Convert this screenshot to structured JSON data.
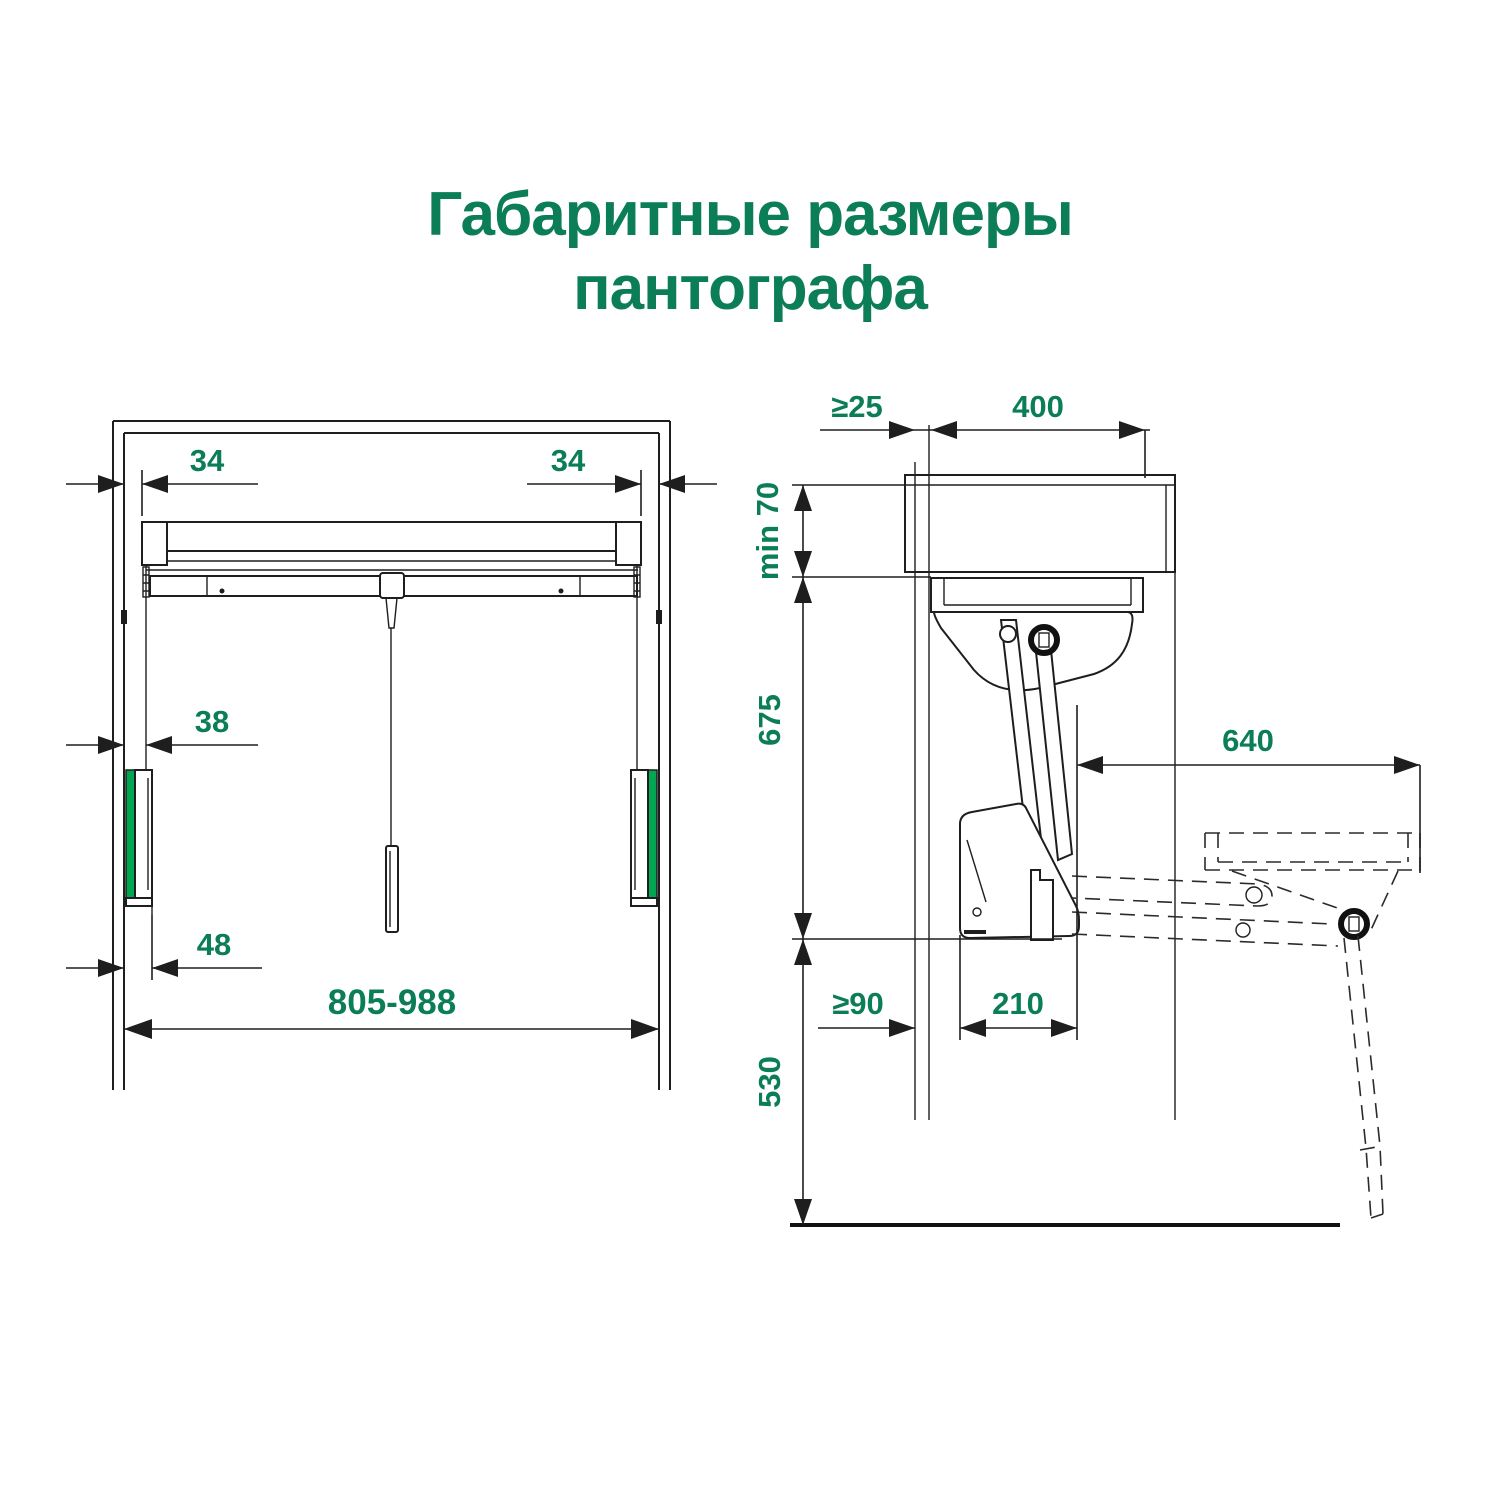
{
  "title": {
    "line1": "Габаритные размеры",
    "line2": "пантографа"
  },
  "colors": {
    "accent_green": "#0B7D57",
    "bright_green": "#00A651",
    "line": "#1E1E1E"
  },
  "front_view": {
    "dims": {
      "offset_left": "34",
      "offset_right": "34",
      "cable_offset": "38",
      "unit_offset": "48",
      "width_range": "805-988"
    }
  },
  "side_view": {
    "dims": {
      "wall_gap": "≥25",
      "depth": "400",
      "top_clearance": "min 70",
      "mech_height": "675",
      "extension": "640",
      "back_clearance": "≥90",
      "mech_depth": "210",
      "floor_height": "530"
    }
  }
}
